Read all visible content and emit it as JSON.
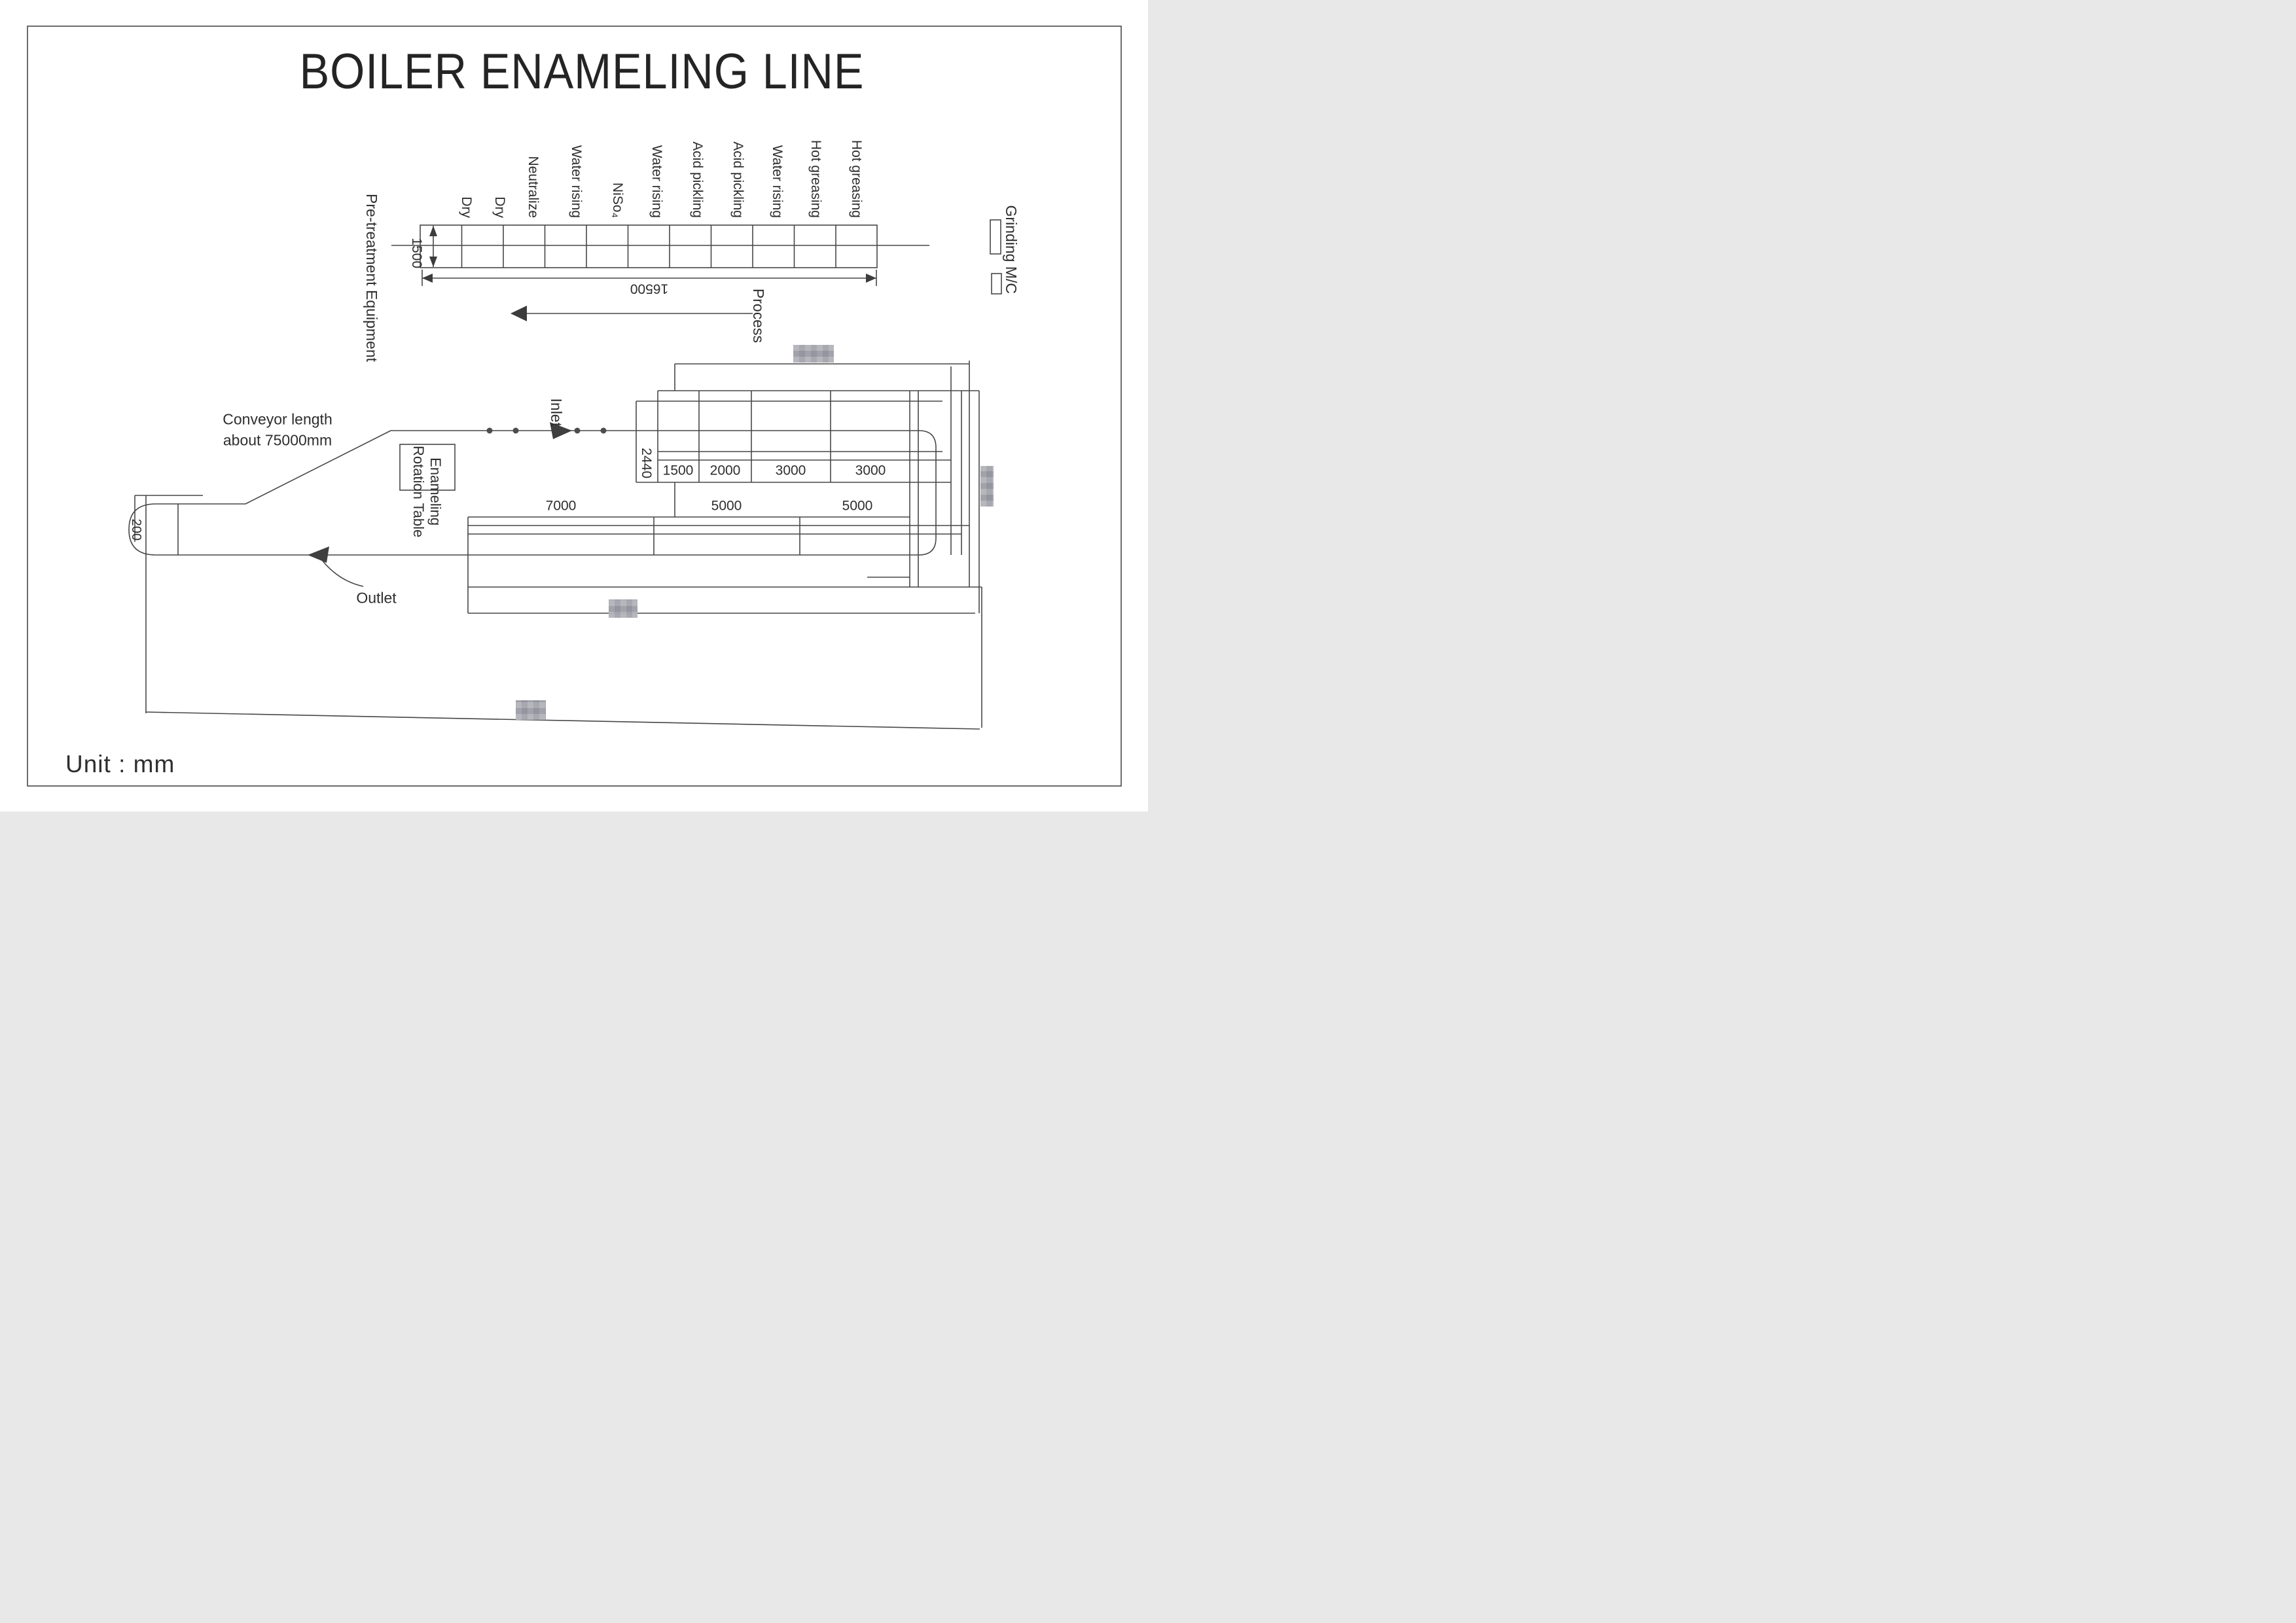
{
  "title": "BOILER ENAMELING LINE",
  "unit_note": "Unit : mm",
  "pretreatment": {
    "label": "Pre-treatment Equipment",
    "stages": [
      "Dry",
      "Dry",
      "Neutralize",
      "Water rising",
      "NiSo₄",
      "Water rising",
      "Acid pickling",
      "Acid pickling",
      "Water rising",
      "Hot greasing",
      "Hot greasing"
    ],
    "tank_height_mm": "1500",
    "tank_length_mm": "16500",
    "process_label": "Process"
  },
  "grinding": {
    "label": "Grinding M/C"
  },
  "conveyor": {
    "note_line1": "Conveyor length",
    "note_line2": "about 75000mm",
    "inlet_label": "Inlet",
    "outlet_label": "Outlet",
    "rotation_table_line1": "Enameling",
    "rotation_table_line2": "Rotation Table"
  },
  "enameling_layout": {
    "height_mm": "2440",
    "top_section_cells_mm": [
      "1500",
      "2000",
      "3000",
      "3000"
    ],
    "furnace_section_cells_mm": [
      "7000",
      "5000",
      "5000"
    ],
    "loop_offset_mm": "200"
  },
  "colors": {
    "ink": "#474747",
    "conveyor": "#4d4d4d",
    "center_line": "#8f8f8f",
    "turn_chord": "#4e8f8f",
    "redaction": "#c3c3c8"
  }
}
